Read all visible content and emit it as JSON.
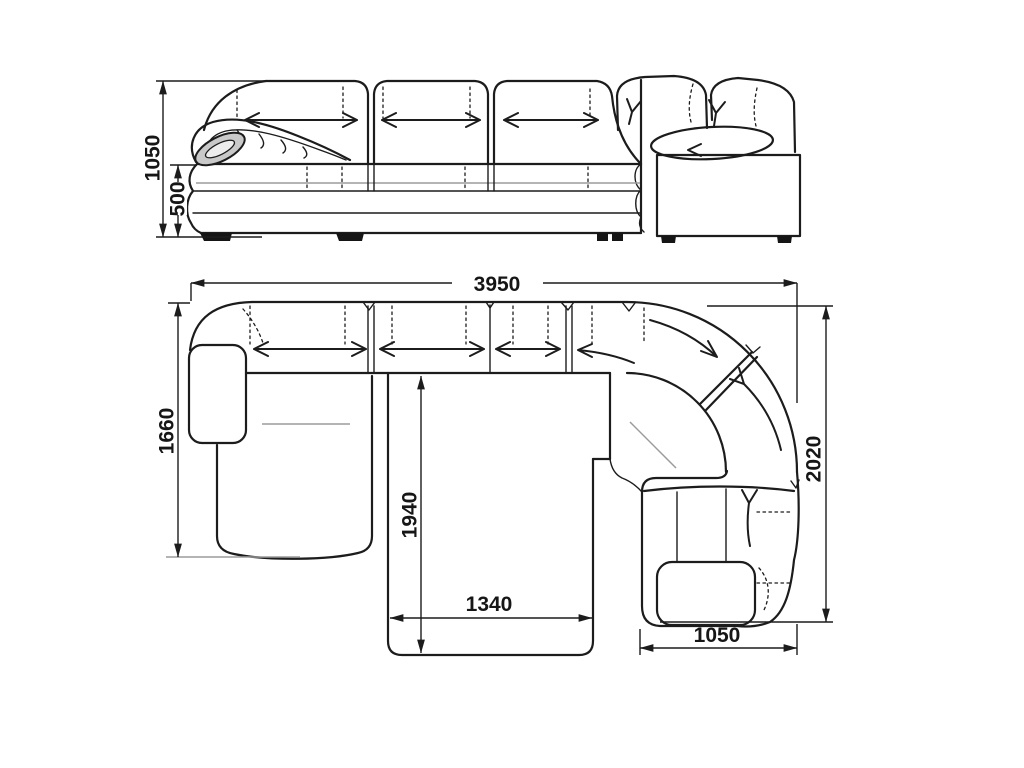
{
  "drawing": {
    "type": "furniture technical drawing",
    "subject": "corner sofa with chaise and pull-out bed, front elevation and plan view",
    "units": "mm",
    "front_view": {
      "total_height": "1050",
      "seat_height": "500"
    },
    "plan_view": {
      "total_width": "3950",
      "left_depth": "1660",
      "bed_length": "1940",
      "bed_width": "1340",
      "right_section_width": "1050",
      "right_depth": "2020"
    }
  },
  "colors": {
    "background": "#ffffff",
    "line": "#1c1c1c",
    "light_line": "#9b9b9b",
    "shade": "#c9c9c9"
  }
}
